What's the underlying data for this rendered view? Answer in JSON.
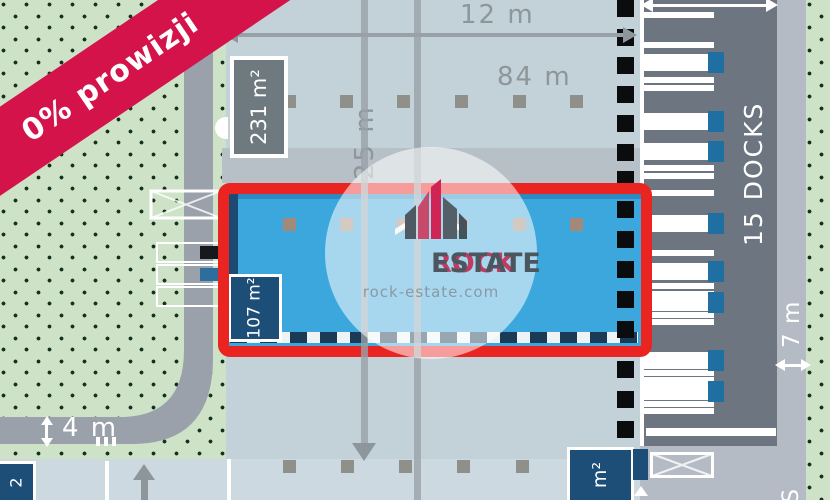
{
  "ribbon": {
    "label": "0% prowizji",
    "color": "#d5134b"
  },
  "watermark": {
    "brand_primary": "ROCK",
    "brand_secondary": "ESTATE",
    "website": "rock-estate.com"
  },
  "dimensions": {
    "top_width": "12 m",
    "hall_length": "84 m",
    "hall_depth": "25 m",
    "left_road_width": "4 m",
    "right_road_width": "7 m"
  },
  "labels": {
    "docks": "15 DOCKS",
    "area_top_unit": "231 m²",
    "area_highlighted_unit": "107 m²",
    "area_bottom_right_fragment": "m²",
    "area_bottom_left_fragment": "2",
    "road_text_fragment": "S"
  },
  "colors": {
    "highlight_fill": "#3ca7dc",
    "highlight_border": "#ea2420",
    "navy_badge": "#1d4e78",
    "gray_badge": "#6f7980",
    "yard": "#6d7680",
    "green": "#cde2c7",
    "road": "#9aa1ab",
    "dimension_gray": "#8d969b"
  },
  "plan_patterns": {
    "dock_square_ys": [
      0,
      29,
      57,
      86,
      115,
      144,
      171,
      201,
      231,
      261,
      291,
      321,
      361,
      391,
      421
    ],
    "yard_stripe_ys": [
      12,
      42,
      77,
      85,
      165,
      173,
      190,
      250,
      283,
      291,
      312,
      319,
      370,
      377,
      401,
      408
    ],
    "yard_wide_stripe_ys": [
      428
    ],
    "yard_truck_ys": [
      52,
      111,
      141,
      213,
      261,
      292,
      350,
      381
    ],
    "column_dot_rows": [
      {
        "y": 95,
        "xs": [
          283,
          340,
          397,
          455,
          513,
          570
        ],
        "color": "#8e9089"
      },
      {
        "y": 218,
        "xs": [
          283,
          340,
          397,
          455,
          513,
          570
        ],
        "color": "#a18a7a"
      },
      {
        "y": 460,
        "xs": [
          283,
          341,
          399,
          457,
          516,
          575
        ],
        "color": "#8e9089"
      }
    ]
  }
}
